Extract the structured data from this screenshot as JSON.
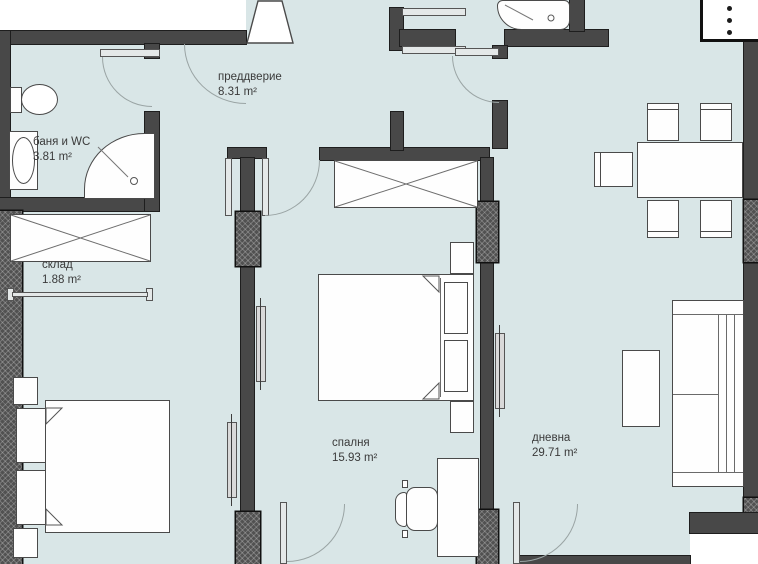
{
  "document": {
    "type": "apartment-floor-plan"
  },
  "rooms": [
    {
      "id": "vestibule",
      "name": "преддверие",
      "area": "8.31 m²"
    },
    {
      "id": "bathroom",
      "name": "баня и WC",
      "area": "3.81 m²"
    },
    {
      "id": "storage",
      "name": "склад",
      "area": "1.88 m²"
    },
    {
      "id": "bedroom",
      "name": "спалня",
      "area": "15.93 m²"
    },
    {
      "id": "living-room",
      "name": "дневна",
      "area": "29.71 m²"
    }
  ],
  "colors": {
    "floor": "#d9e6e7",
    "wall": "#484848",
    "wall_outline": "#1e1e1e",
    "outside": "#ffffff",
    "furniture_outline": "#4a4a4a",
    "door_arc": "#9aa4a4"
  }
}
